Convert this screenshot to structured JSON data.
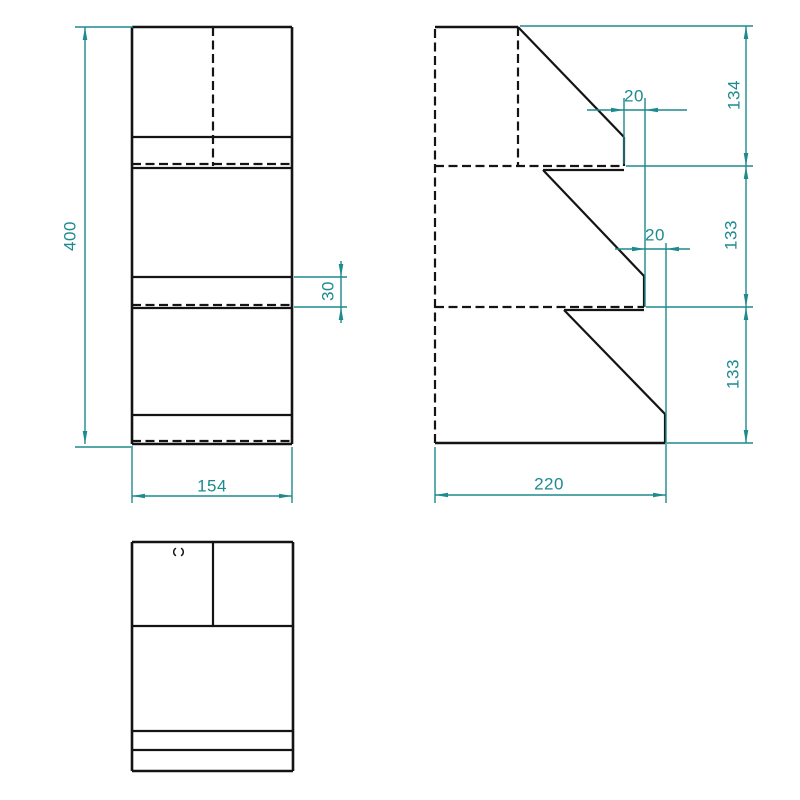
{
  "meta": {
    "drawing_type": "orthographic technical drawing, three views of stepped shelf",
    "canvas": {
      "width": 800,
      "height": 800
    },
    "colors": {
      "background": "#ffffff",
      "object_line": "#141414",
      "dimension": "#1d8a8e"
    },
    "stroke": {
      "outline_width": 2.6,
      "inner_width": 2.2,
      "hidden_width": 2.2,
      "dim_width": 1.4,
      "hidden_dash": "9 4.5"
    },
    "arrow": {
      "length": 13,
      "half_width": 2.3
    }
  },
  "views": {
    "front": {
      "name": "front-view",
      "solid": [
        [
          132,
          27,
          132,
          444,
          2.6
        ],
        [
          292,
          27,
          292,
          444,
          2.6
        ],
        [
          132,
          27,
          292,
          27,
          2.6
        ],
        [
          132,
          137,
          292,
          137,
          2.2
        ],
        [
          132,
          168,
          292,
          168,
          2.2
        ],
        [
          132,
          277,
          292,
          277,
          2.2
        ],
        [
          132,
          308,
          292,
          308,
          2.2
        ],
        [
          132,
          415,
          292,
          415,
          2.2
        ],
        [
          132,
          444,
          292,
          444,
          2.6
        ]
      ],
      "dashed": [
        [
          213,
          27,
          213,
          166,
          2.2
        ],
        [
          132,
          164,
          292,
          164,
          2.2
        ],
        [
          132,
          305,
          292,
          305,
          2.2
        ],
        [
          132,
          441,
          292,
          441,
          2.2
        ]
      ]
    },
    "side": {
      "name": "side-view",
      "solid": [
        [
          435,
          27,
          518,
          27,
          2.6
        ],
        [
          518,
          27,
          624,
          137,
          2.2
        ],
        [
          624,
          137,
          624,
          166,
          2.2
        ],
        [
          543,
          170,
          624,
          170,
          2.2
        ],
        [
          543,
          170,
          644,
          276,
          2.2
        ],
        [
          644,
          276,
          644,
          307,
          2.2
        ],
        [
          564,
          310,
          644,
          310,
          2.2
        ],
        [
          564,
          310,
          665,
          414,
          2.2
        ],
        [
          665,
          414,
          665,
          443,
          2.2
        ],
        [
          435,
          443,
          665,
          443,
          2.6
        ]
      ],
      "dashed": [
        [
          435,
          29,
          435,
          443,
          2.2
        ],
        [
          518,
          27,
          518,
          166,
          2.2
        ],
        [
          435,
          166,
          624,
          166,
          2.2
        ],
        [
          435,
          307,
          644,
          307,
          2.2
        ]
      ]
    },
    "top": {
      "name": "top-view",
      "solid": [
        [
          132,
          542,
          132,
          771,
          2.6
        ],
        [
          293,
          542,
          293,
          771,
          2.6
        ],
        [
          132,
          542,
          293,
          542,
          2.6
        ],
        [
          132,
          771,
          293,
          771,
          2.6
        ],
        [
          213,
          542,
          213,
          626,
          2.2
        ],
        [
          132,
          626,
          293,
          626,
          2.2
        ],
        [
          132,
          731,
          293,
          731,
          2.2
        ],
        [
          132,
          750,
          293,
          750,
          2.2
        ]
      ],
      "dashed": [],
      "hole_mark": {
        "x": 178.5,
        "y": 552,
        "height": 7.5,
        "gap": 5
      }
    }
  },
  "dimensions": [
    {
      "name": "dim-overall-height",
      "label": "400",
      "rotated": true,
      "text": [
        70,
        236
      ],
      "line": [
        85,
        27,
        85,
        444
      ],
      "arrows": [
        [
          85,
          27,
          "up"
        ],
        [
          85,
          444,
          "down"
        ]
      ],
      "ext": [
        [
          75,
          27,
          133,
          27
        ],
        [
          75,
          447,
          133,
          447
        ]
      ]
    },
    {
      "name": "dim-front-width",
      "label": "154",
      "rotated": false,
      "text": [
        212,
        486
      ],
      "line": [
        132,
        496,
        292,
        496
      ],
      "arrows": [
        [
          132,
          496,
          "left"
        ],
        [
          292,
          496,
          "right"
        ]
      ],
      "ext": [
        [
          132,
          448,
          132,
          503
        ],
        [
          292,
          447,
          292,
          503
        ]
      ]
    },
    {
      "name": "dim-step-face-height",
      "label": "30",
      "rotated": true,
      "text": [
        328,
        291
      ],
      "line": [
        341,
        261,
        341,
        323
      ],
      "arrows": [
        [
          341,
          277,
          "down"
        ],
        [
          341,
          307,
          "up"
        ]
      ],
      "ext": [
        [
          294,
          277,
          347,
          277
        ],
        [
          294,
          307,
          347,
          307
        ]
      ]
    },
    {
      "name": "dim-tier1-height",
      "label": "134",
      "rotated": true,
      "text": [
        734,
        95
      ],
      "line": [
        746,
        26,
        746,
        166
      ],
      "arrows": [
        [
          746,
          26,
          "up"
        ],
        [
          746,
          166,
          "down"
        ]
      ],
      "ext": [
        [
          520,
          26,
          753,
          26
        ],
        [
          626,
          166,
          753,
          166
        ]
      ]
    },
    {
      "name": "dim-tier2-height",
      "label": "133",
      "rotated": true,
      "text": [
        731,
        235
      ],
      "line": [
        746,
        166,
        746,
        307
      ],
      "arrows": [
        [
          746,
          166,
          "up"
        ],
        [
          746,
          307,
          "down"
        ]
      ],
      "ext": [
        [
          646,
          307,
          753,
          307
        ]
      ]
    },
    {
      "name": "dim-tier3-height",
      "label": "133",
      "rotated": true,
      "text": [
        733,
        374
      ],
      "line": [
        746,
        307,
        746,
        443
      ],
      "arrows": [
        [
          746,
          307,
          "up"
        ],
        [
          746,
          443,
          "down"
        ]
      ],
      "ext": [
        [
          667,
          443,
          753,
          443
        ]
      ]
    },
    {
      "name": "dim-step-offset-upper",
      "label": "20",
      "rotated": false,
      "text": [
        634,
        96
      ],
      "line": [
        587,
        110,
        687,
        110
      ],
      "arrows": [
        [
          624,
          110,
          "right"
        ],
        [
          645,
          110,
          "left"
        ]
      ],
      "ext": [
        [
          624,
          98,
          624,
          164
        ],
        [
          645,
          98,
          645,
          307
        ]
      ]
    },
    {
      "name": "dim-step-offset-lower",
      "label": "20",
      "rotated": false,
      "text": [
        655,
        235
      ],
      "line": [
        615,
        249,
        690,
        249
      ],
      "arrows": [
        [
          645,
          249,
          "right"
        ],
        [
          666,
          249,
          "left"
        ]
      ],
      "ext": [
        [
          666,
          243,
          666,
          503
        ]
      ]
    },
    {
      "name": "dim-depth",
      "label": "220",
      "rotated": false,
      "text": [
        549,
        484
      ],
      "line": [
        435,
        495,
        666,
        495
      ],
      "arrows": [
        [
          435,
          495,
          "left"
        ],
        [
          666,
          495,
          "right"
        ]
      ],
      "ext": [
        [
          435,
          447,
          435,
          503
        ]
      ]
    }
  ]
}
